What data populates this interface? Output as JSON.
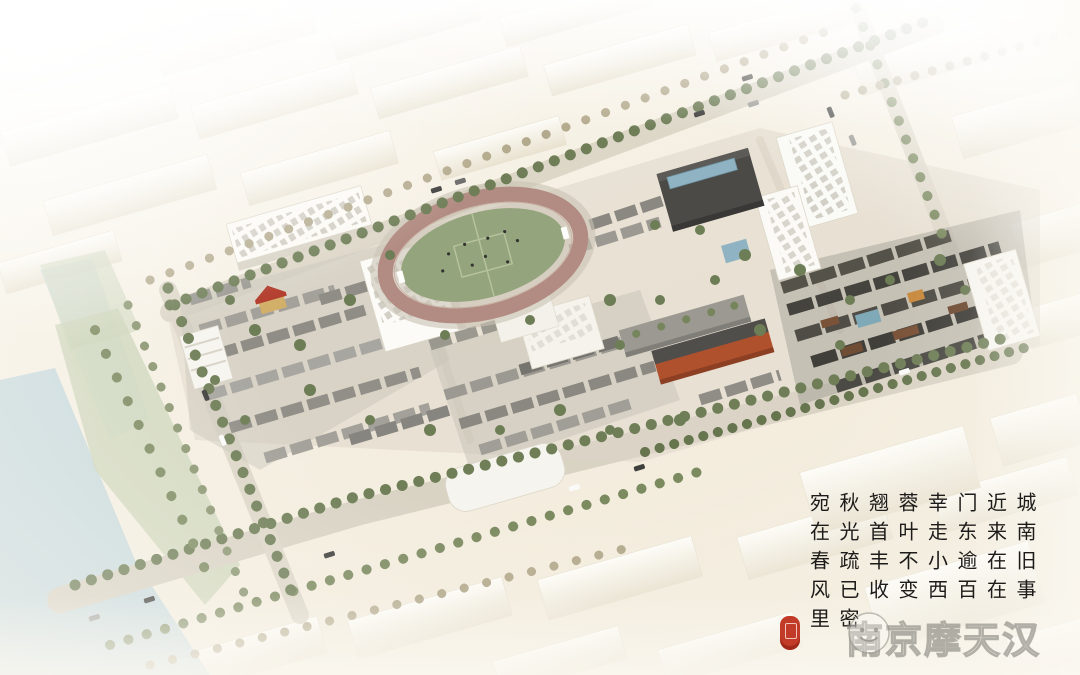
{
  "scene": {
    "description": "Aerial axonometric architectural rendering of an urban historic district: a colorful central block (school with running track, grey-roofed historic houses, red-brick building, dark-timber quarter, tree-lined streets) surrounded by pale cream context buildings, with a canal and riverside park on the left",
    "features": [
      "context-city-blocks",
      "canal",
      "riverside-park",
      "tree-lined-streets",
      "school-buildings",
      "running-track-field",
      "soccer-players",
      "historic-grey-roof-houses",
      "red-brick-building",
      "dark-timber-historic-quarter",
      "modern-white-slab-buildings",
      "dark-roof-building-with-glass-skylight",
      "red-roof-villa",
      "cars-on-roads",
      "poem-calligraphy",
      "red-seal",
      "watermark-logo"
    ]
  },
  "poem": {
    "script": "Chinese calligraphy, vertical columns read right to left, top to bottom",
    "columns": [
      {
        "chars": "城南旧事"
      },
      {
        "chars": "近来在在"
      },
      {
        "chars": "门东逾百"
      },
      {
        "chars": "幸走小西"
      },
      {
        "chars": "蓉叶不变"
      },
      {
        "chars": "翘首丰收"
      },
      {
        "chars": "秋光疏已密"
      },
      {
        "chars": "宛在春风里"
      }
    ]
  },
  "seal": {
    "icon": "red-lantern-seal",
    "color": "#c23a28"
  },
  "watermark": {
    "logo_icon": "smiling-mascot-face",
    "text": "南京摩天汉"
  },
  "palette": {
    "background_cream": "#f5efe2",
    "context_building": "#f2ecdd",
    "road_grey": "#d9d3c4",
    "track_ring": "#b28c82",
    "field_green": "#94a47d",
    "tree_green": "#6f7e57",
    "context_tree": "#b3a98c",
    "red_brick": "#b0512d",
    "dark_roof": "#45433e",
    "grey_roof": "#9b9992",
    "timber_brown": "#6f4c34",
    "water_blue": "#c6d8dd",
    "glass_blue": "#8fb3c2",
    "park_green": "#ccd5b9",
    "ink_black": "#1e1c1a",
    "watermark_grey": "#8a8780"
  }
}
